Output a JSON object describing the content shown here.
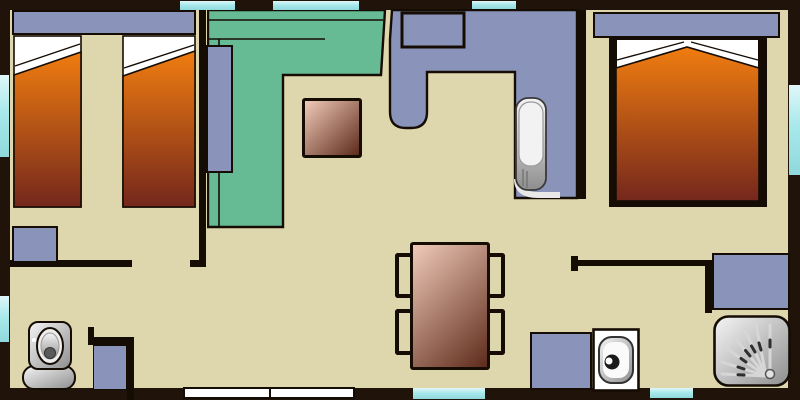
{
  "meta": {
    "type": "floor-plan",
    "view": "top-down",
    "subject": "mobile-home layout with two bedrooms, living area, kitchen, bathroom and WC",
    "visible_text": ""
  },
  "colors": {
    "wall": "#20130a",
    "line": "#150c04",
    "floor": "#ded6ad",
    "furniture_blue": "#8a93ba",
    "sofa_green": "#67bb94",
    "window_cyan": "#a9e9eb",
    "door_white": "#ffffff",
    "bed_gradient_top": "#f07d10",
    "bed_gradient_bottom": "#74271c",
    "wood_gradient_light": "#f0cab9",
    "wood_gradient_dark": "#5e2b1b",
    "fixture_light": "#f5f5f5",
    "fixture_mid": "#cccccc",
    "fixture_dark": "#8e8e8e"
  },
  "rooms": [
    {
      "name": "twin-bedroom",
      "position": "top-left",
      "items": [
        "headboard-shelf",
        "single-bed",
        "single-bed",
        "low-cabinet"
      ]
    },
    {
      "name": "living-area",
      "position": "top-center",
      "items": [
        "l-shaped-sofa",
        "side-cabinet",
        "coffee-table"
      ]
    },
    {
      "name": "kitchen",
      "position": "top-center-right",
      "items": [
        "l-shaped-counter",
        "stove",
        "kitchen-sink"
      ]
    },
    {
      "name": "double-bedroom",
      "position": "right",
      "items": [
        "headboard-shelf",
        "double-bed",
        "wardrobe-sides"
      ]
    },
    {
      "name": "bathroom",
      "position": "bottom-right",
      "items": [
        "storage-cabinet",
        "shower",
        "washbasin",
        "vanity-cabinet"
      ]
    },
    {
      "name": "wc",
      "position": "bottom-left",
      "items": [
        "toilet",
        "small-cabinet"
      ]
    },
    {
      "name": "dining-area",
      "position": "bottom-center",
      "items": [
        "dining-table",
        "chair",
        "chair",
        "chair",
        "chair"
      ]
    }
  ],
  "openings": {
    "windows_top": 3,
    "windows_left": 2,
    "windows_right": 1,
    "windows_bottom": 2,
    "entry_door": "white double door in bottom wall"
  }
}
